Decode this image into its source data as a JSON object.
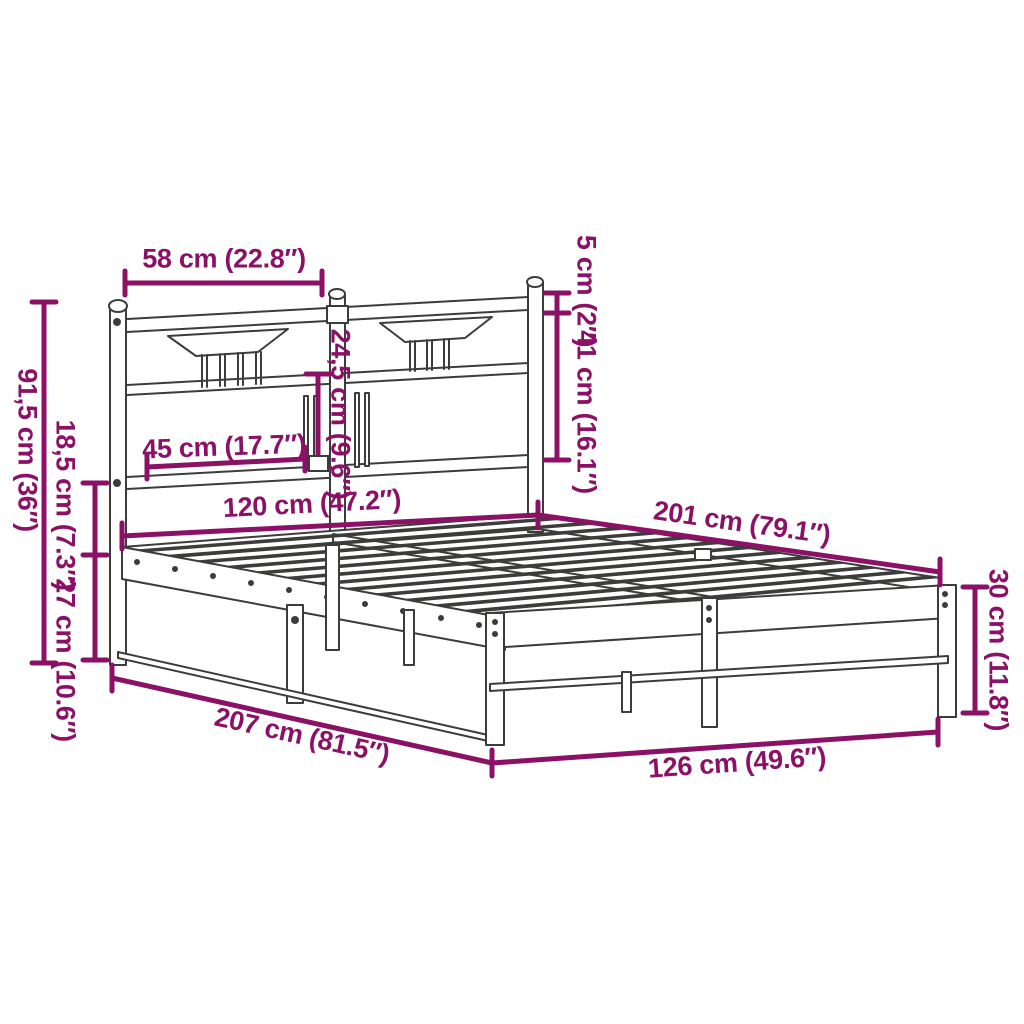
{
  "diagram": {
    "type": "product-dimension-diagram",
    "subject": "metal bed frame with slatted base and headboard",
    "background_color": "#ffffff",
    "line_color": "#3c3c3b",
    "dimension_color": "#8b1166",
    "unit_primary": "cm",
    "unit_secondary": "inch",
    "dimensions": [
      {
        "id": "headboard-section-width",
        "label": "58 cm (22.8″)",
        "value_cm": 58,
        "value_in": 22.8
      },
      {
        "id": "headboard-rail-thickness",
        "label": "5 cm (2″)",
        "value_cm": 5,
        "value_in": 2
      },
      {
        "id": "headboard-upper-height",
        "label": "41 cm (16.1″)",
        "value_cm": 41,
        "value_in": 16.1
      },
      {
        "id": "headboard-total-height",
        "label": "91,5 cm (36″)",
        "value_cm": 91.5,
        "value_in": 36
      },
      {
        "id": "headboard-base-gap",
        "label": "18,5 cm (7.3″)",
        "value_cm": 18.5,
        "value_in": 7.3
      },
      {
        "id": "base-height",
        "label": "27 cm (10.6″)",
        "value_cm": 27,
        "value_in": 10.6
      },
      {
        "id": "headboard-panel-width",
        "label": "45 cm (17.7″)",
        "value_cm": 45,
        "value_in": 17.7
      },
      {
        "id": "headboard-panel-height",
        "label": "24,5 cm (9.6″)",
        "value_cm": 24.5,
        "value_in": 9.6
      },
      {
        "id": "bed-inner-width",
        "label": "120 cm (47.2″)",
        "value_cm": 120,
        "value_in": 47.2
      },
      {
        "id": "bed-inner-length",
        "label": "201 cm (79.1″)",
        "value_cm": 201,
        "value_in": 79.1
      },
      {
        "id": "footboard-height",
        "label": "30 cm (11.8″)",
        "value_cm": 30,
        "value_in": 11.8
      },
      {
        "id": "bed-outer-length",
        "label": "207 cm (81.5″)",
        "value_cm": 207,
        "value_in": 81.5
      },
      {
        "id": "bed-outer-width",
        "label": "126 cm (49.6″)",
        "value_cm": 126,
        "value_in": 49.6
      }
    ]
  }
}
